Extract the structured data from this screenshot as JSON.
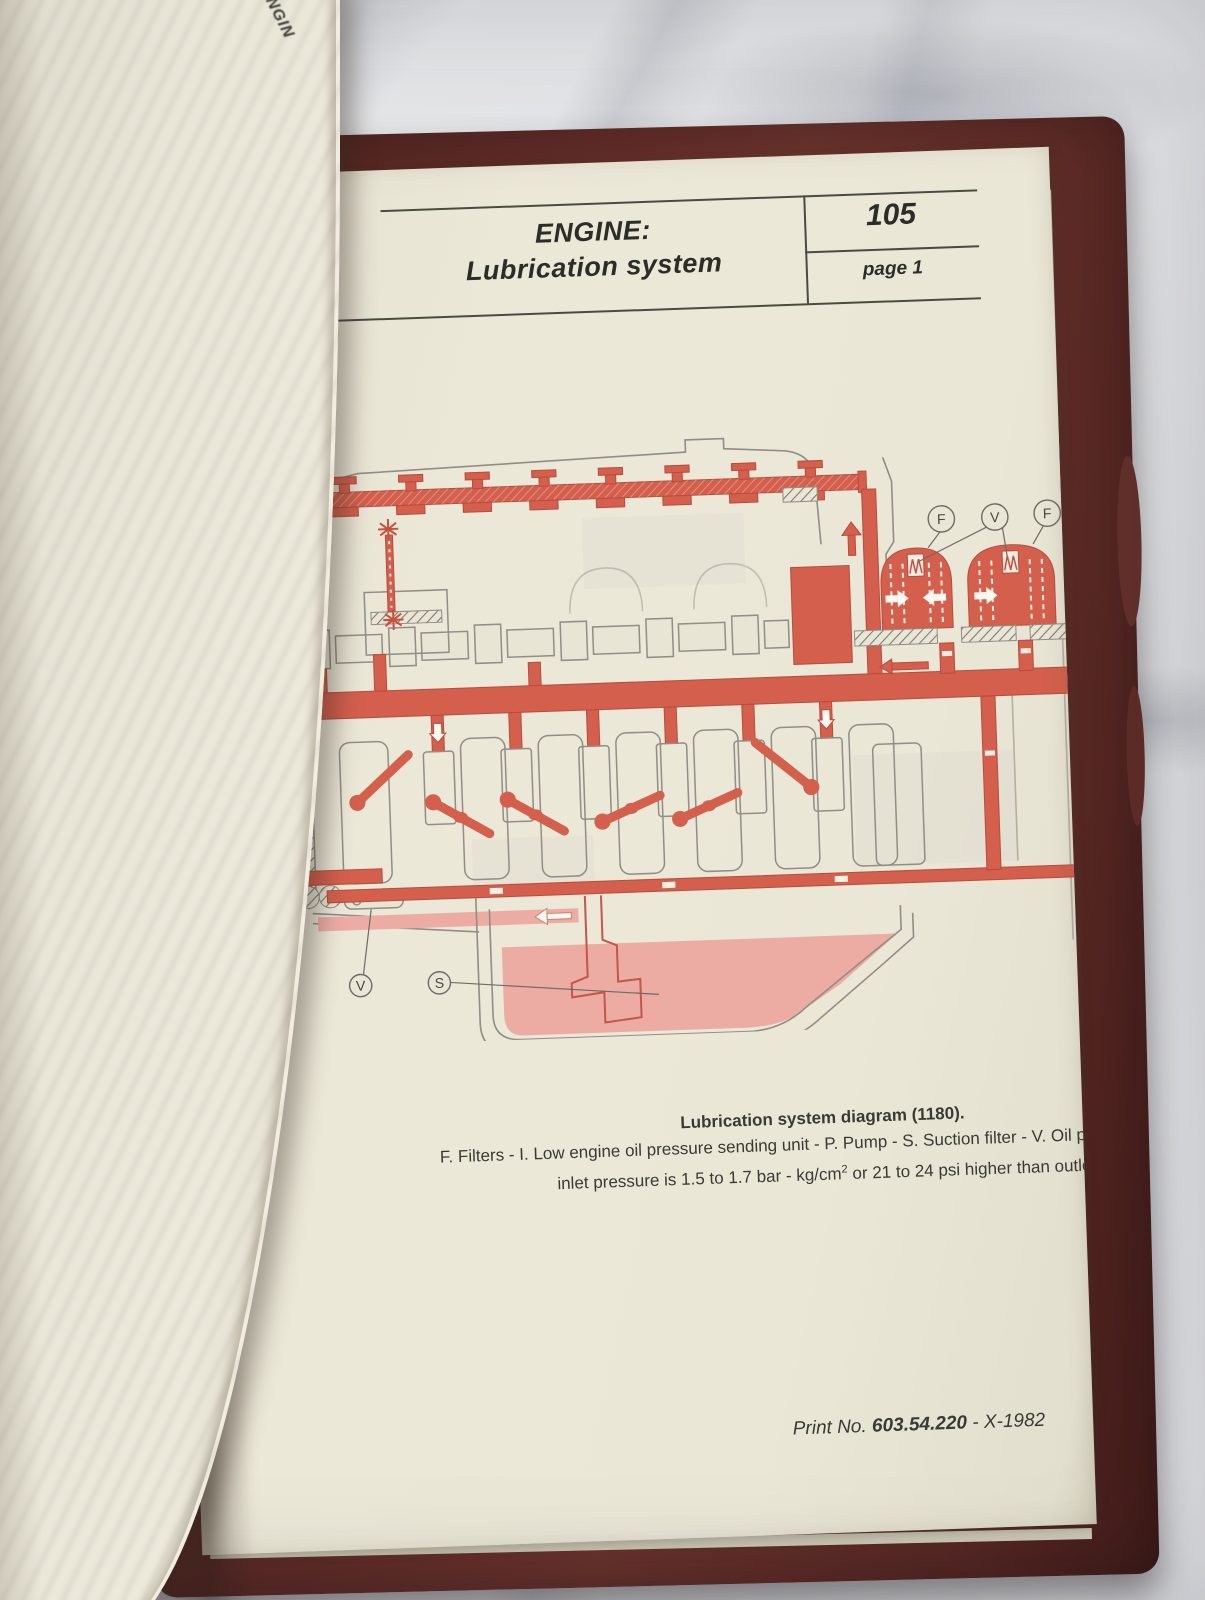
{
  "scene": {
    "surface": "marble-countertop",
    "book": {
      "cover_color": "#5e2b27",
      "page_color": "#e9e5d5"
    }
  },
  "left_page": {
    "edge_text": "ENGIN"
  },
  "page": {
    "header": {
      "title_line1": "ENGINE:",
      "title_line2": "Lubrication system",
      "page_number": "105",
      "page_label": "page 1"
    },
    "caption": {
      "title": "Lubrication system diagram (1180).",
      "line1": "F. Filters - I. Low engine oil pressure sending unit - P. Pump - S. Suction filter - V. Oil pressure relief va",
      "line2_part1": "inlet pressure is 1.5 to 1.7 bar - kg/cm",
      "line2_sup": "2",
      "line2_part2": " or 21 to 24 psi higher than outle"
    },
    "footer": {
      "label": "Print No. ",
      "number": "603.54.220",
      "year": " - X-1982"
    },
    "diagram": {
      "labels": {
        "filter_left": "F",
        "relief_valve_filters": "V",
        "filter_right": "F",
        "pump": "P",
        "relief_valve_pump": "V",
        "suction_filter": "S"
      },
      "colors": {
        "oil_red": "#d45f4d",
        "oil_pink": "#edaca3",
        "outline_grey": "#8f8d85"
      }
    }
  }
}
